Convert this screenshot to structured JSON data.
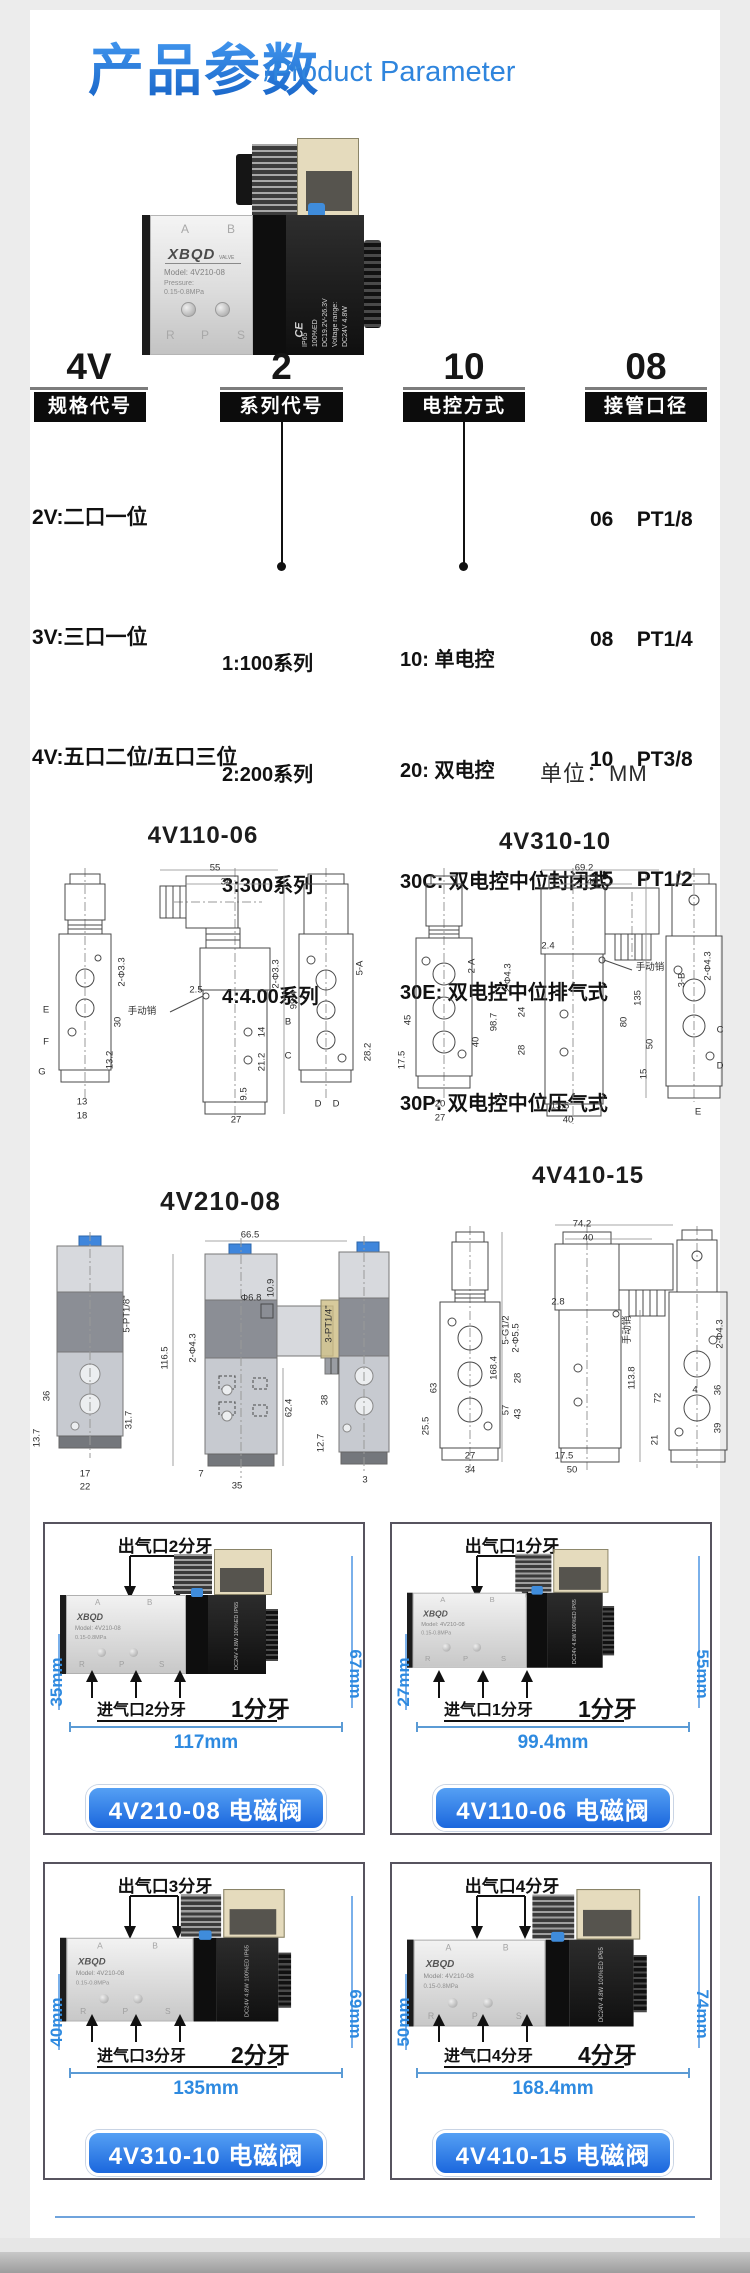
{
  "header": {
    "title_zh": "产品参数",
    "title_en": "/Product Parameter"
  },
  "unit_note": "单位：MM",
  "valve_photo": {
    "brand": "XBQD",
    "brand_suffix": "VALVE",
    "model_line": "Model:  4V210-08",
    "pressure_line1": "Pressure:",
    "pressure_line2": "0.15-0.8MPa",
    "port_a": "A",
    "port_b": "B",
    "port_r": "R",
    "port_p": "P",
    "port_s": "S",
    "coil_lines": [
      "DC24V  4.8W",
      "Voltage range:",
      "DC19.2V-26.3V",
      "100%ED",
      "IP65"
    ],
    "ce_mark": "CE",
    "coil_text_compact": "DC24V 4.8W 100%ED IP65"
  },
  "model_code": {
    "columns": [
      {
        "code": "4V",
        "badge": "规格代号",
        "items": [
          "2V:二口一位",
          "3V:三口一位",
          "4V:五口二位/五口三位"
        ]
      },
      {
        "code": "2",
        "badge": "系列代号",
        "items": [
          "1:100系列",
          "2:200系列",
          "3:300系列",
          "4:4.00系列"
        ]
      },
      {
        "code": "10",
        "badge": "电控方式",
        "items": [
          "10: 单电控",
          "20: 双电控",
          "30C: 双电控中位封闭式",
          "30E: 双电控中位排气式",
          "30P: 双电控中位压气式"
        ]
      },
      {
        "code": "08",
        "badge": "接管口径",
        "items": [
          "06    PT1/8",
          "08    PT1/4",
          "10    PT3/8",
          "15    PT1/2"
        ]
      }
    ]
  },
  "drawings": [
    {
      "title": "4V110-06",
      "labels": [
        {
          "t": "55",
          "x": 185,
          "y": 6
        },
        {
          "t": "34",
          "x": 196,
          "y": 20
        },
        {
          "t": "手动销",
          "x": 112,
          "y": 148
        },
        {
          "t": "2.5",
          "x": 166,
          "y": 128
        },
        {
          "t": "2-Φ3.3",
          "x": 246,
          "y": 112,
          "r": 1
        },
        {
          "t": "99.4",
          "x": 264,
          "y": 138,
          "r": 1
        },
        {
          "t": "14",
          "x": 232,
          "y": 170,
          "r": 1
        },
        {
          "t": "21.2",
          "x": 232,
          "y": 200,
          "r": 1
        },
        {
          "t": "9.5",
          "x": 214,
          "y": 232,
          "r": 1
        },
        {
          "t": "27",
          "x": 206,
          "y": 258
        },
        {
          "t": "2-Φ3.3",
          "x": 92,
          "y": 110,
          "r": 1
        },
        {
          "t": "30",
          "x": 88,
          "y": 160,
          "r": 1
        },
        {
          "t": "13.2",
          "x": 80,
          "y": 198,
          "r": 1
        },
        {
          "t": "E",
          "x": 16,
          "y": 148
        },
        {
          "t": "F",
          "x": 16,
          "y": 180
        },
        {
          "t": "G",
          "x": 12,
          "y": 210
        },
        {
          "t": "13",
          "x": 52,
          "y": 240
        },
        {
          "t": "18",
          "x": 52,
          "y": 254
        },
        {
          "t": "5-A",
          "x": 330,
          "y": 106,
          "r": 1
        },
        {
          "t": "B",
          "x": 258,
          "y": 160
        },
        {
          "t": "C",
          "x": 258,
          "y": 194
        },
        {
          "t": "28.2",
          "x": 338,
          "y": 190,
          "r": 1
        },
        {
          "t": "D",
          "x": 288,
          "y": 242
        },
        {
          "t": "D",
          "x": 306,
          "y": 242
        }
      ]
    },
    {
      "title": "4V310-10",
      "labels": [
        {
          "t": "69.2",
          "x": 196,
          "y": 6
        },
        {
          "t": "40",
          "x": 204,
          "y": 20
        },
        {
          "t": "2.4",
          "x": 160,
          "y": 84
        },
        {
          "t": "手动销",
          "x": 262,
          "y": 104
        },
        {
          "t": "2-Φ4.3",
          "x": 120,
          "y": 116,
          "r": 1
        },
        {
          "t": "98.7",
          "x": 106,
          "y": 160,
          "r": 1
        },
        {
          "t": "24",
          "x": 134,
          "y": 150,
          "r": 1
        },
        {
          "t": "28",
          "x": 134,
          "y": 188,
          "r": 1
        },
        {
          "t": "80",
          "x": 236,
          "y": 160,
          "r": 1
        },
        {
          "t": "13.5",
          "x": 172,
          "y": 244
        },
        {
          "t": "40",
          "x": 180,
          "y": 258
        },
        {
          "t": "2-A",
          "x": 84,
          "y": 104,
          "r": 1
        },
        {
          "t": "45",
          "x": 20,
          "y": 158,
          "r": 1
        },
        {
          "t": "40",
          "x": 88,
          "y": 180,
          "r": 1
        },
        {
          "t": "17.5",
          "x": 14,
          "y": 198,
          "r": 1
        },
        {
          "t": "20",
          "x": 52,
          "y": 242
        },
        {
          "t": "27",
          "x": 52,
          "y": 256
        },
        {
          "t": "135",
          "x": 250,
          "y": 136,
          "r": 1
        },
        {
          "t": "3-B",
          "x": 294,
          "y": 118,
          "r": 1
        },
        {
          "t": "2-Φ4.3",
          "x": 320,
          "y": 104,
          "r": 1
        },
        {
          "t": "50",
          "x": 262,
          "y": 182,
          "r": 1
        },
        {
          "t": "15",
          "x": 256,
          "y": 212,
          "r": 1
        },
        {
          "t": "C",
          "x": 332,
          "y": 168
        },
        {
          "t": "D",
          "x": 332,
          "y": 204
        },
        {
          "t": "E",
          "x": 310,
          "y": 250
        }
      ]
    },
    {
      "title": "4V210-08",
      "labels": [
        {
          "t": "66.5",
          "x": 225,
          "y": 7
        },
        {
          "t": "116.5",
          "x": 140,
          "y": 130,
          "r": 1
        },
        {
          "t": "2-Φ4.3",
          "x": 168,
          "y": 120,
          "r": 1
        },
        {
          "t": "Φ6.8",
          "x": 226,
          "y": 70
        },
        {
          "t": "10.9",
          "x": 246,
          "y": 60,
          "r": 1
        },
        {
          "t": "62.4",
          "x": 264,
          "y": 180,
          "r": 1
        },
        {
          "t": "7",
          "x": 176,
          "y": 246
        },
        {
          "t": "35",
          "x": 212,
          "y": 258
        },
        {
          "t": "5-PT1/8\"",
          "x": 102,
          "y": 86,
          "r": 1
        },
        {
          "t": "36",
          "x": 22,
          "y": 168,
          "r": 1
        },
        {
          "t": "13.7",
          "x": 12,
          "y": 210,
          "r": 1
        },
        {
          "t": "31.7",
          "x": 104,
          "y": 192,
          "r": 1
        },
        {
          "t": "17",
          "x": 60,
          "y": 246
        },
        {
          "t": "22",
          "x": 60,
          "y": 259
        },
        {
          "t": "3-PT1/4\"",
          "x": 304,
          "y": 96,
          "r": 1
        },
        {
          "t": "38",
          "x": 300,
          "y": 172,
          "r": 1
        },
        {
          "t": "12.7",
          "x": 296,
          "y": 215,
          "r": 1
        },
        {
          "t": "3",
          "x": 340,
          "y": 252
        }
      ]
    },
    {
      "title": "4V410-15",
      "labels": [
        {
          "t": "74.2",
          "x": 170,
          "y": 6
        },
        {
          "t": "40",
          "x": 176,
          "y": 20
        },
        {
          "t": "2.8",
          "x": 146,
          "y": 84
        },
        {
          "t": "手动销",
          "x": 214,
          "y": 112,
          "r": 1
        },
        {
          "t": "2-Φ5.5",
          "x": 104,
          "y": 120,
          "r": 1
        },
        {
          "t": "168.4",
          "x": 82,
          "y": 150,
          "r": 1
        },
        {
          "t": "28",
          "x": 106,
          "y": 160,
          "r": 1
        },
        {
          "t": "43",
          "x": 106,
          "y": 196,
          "r": 1
        },
        {
          "t": "113.8",
          "x": 220,
          "y": 160,
          "r": 1
        },
        {
          "t": "17.5",
          "x": 152,
          "y": 238
        },
        {
          "t": "50",
          "x": 160,
          "y": 252
        },
        {
          "t": "5-G1/2",
          "x": 94,
          "y": 112,
          "r": 1
        },
        {
          "t": "63",
          "x": 22,
          "y": 170,
          "r": 1
        },
        {
          "t": "25.5",
          "x": 14,
          "y": 208,
          "r": 1
        },
        {
          "t": "57",
          "x": 94,
          "y": 192,
          "r": 1
        },
        {
          "t": "27",
          "x": 58,
          "y": 238
        },
        {
          "t": "34",
          "x": 58,
          "y": 252
        },
        {
          "t": "2-Φ4.3",
          "x": 308,
          "y": 116,
          "r": 1
        },
        {
          "t": "72",
          "x": 246,
          "y": 180,
          "r": 1
        },
        {
          "t": "4",
          "x": 283,
          "y": 172
        },
        {
          "t": "36",
          "x": 306,
          "y": 172,
          "r": 1
        },
        {
          "t": "39",
          "x": 306,
          "y": 210,
          "r": 1
        },
        {
          "t": "21",
          "x": 243,
          "y": 222,
          "r": 1
        }
      ]
    }
  ],
  "cards": [
    {
      "model": "4V210-08 电磁阀",
      "outlet": "出气口2分牙",
      "inlet": "进气口2分牙",
      "thread": "1分牙",
      "body_height": "35mm",
      "total_height": "67mm",
      "width": "117mm"
    },
    {
      "model": "4V110-06 电磁阀",
      "outlet": "出气口1分牙",
      "inlet": "进气口1分牙",
      "thread": "1分牙",
      "body_height": "27mm",
      "total_height": "55mm",
      "width": "99.4mm"
    },
    {
      "model": "4V310-10 电磁阀",
      "outlet": "出气口3分牙",
      "inlet": "进气口3分牙",
      "thread": "2分牙",
      "body_height": "40mm",
      "total_height": "69mm",
      "width": "135mm"
    },
    {
      "model": "4V410-15 电磁阀",
      "outlet": "出气口4分牙",
      "inlet": "进气口4分牙",
      "thread": "4分牙",
      "body_height": "50mm",
      "total_height": "74mm",
      "width": "168.4mm"
    }
  ],
  "colors": {
    "accent_blue": "#2f85dd",
    "dim_blue": "#2e8ae0",
    "button_blue": "#1b67dd",
    "badge_black": "#0c0c0c"
  }
}
